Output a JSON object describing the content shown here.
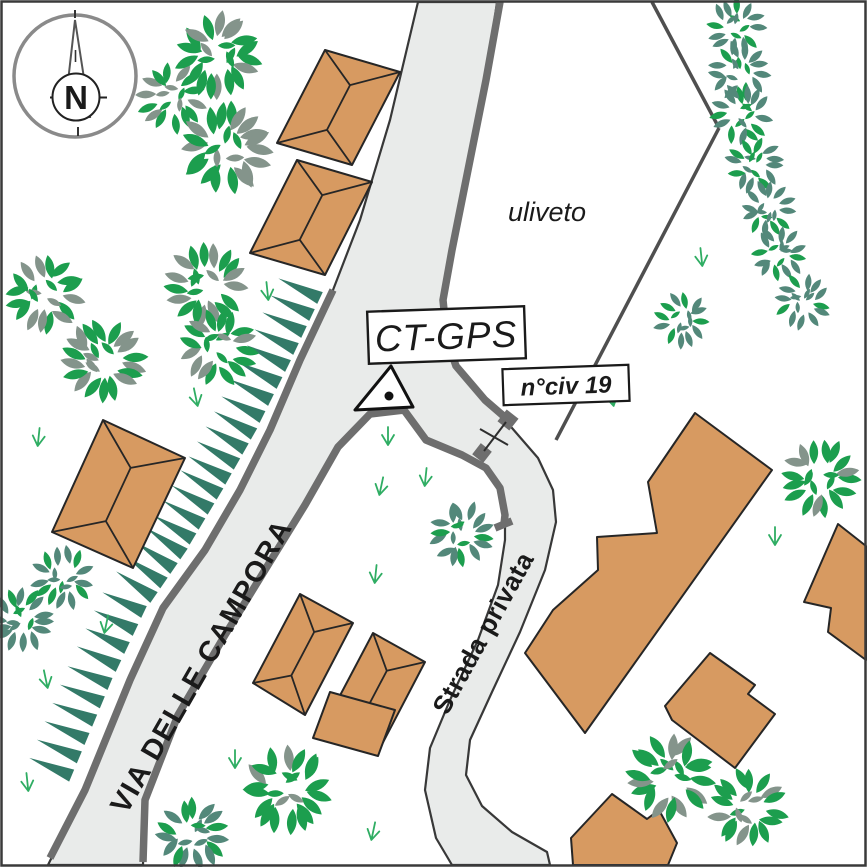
{
  "labels": {
    "compass_north": "N",
    "street_main": "VIA DELLE CAMPORA",
    "street_private": "Strada privata",
    "station": "CT-GPS",
    "civic_number": "n°civ 19",
    "olive_grove": "uliveto"
  },
  "colors": {
    "background": "#FFFFFF",
    "road_fill": "#E9EBEA",
    "road_edge": "#383838",
    "wall_gray": "#6E6E6E",
    "fence_gray": "#4F4F4F",
    "building_fill": "#D79A61",
    "building_edge": "#262626",
    "leaf_green": "#1C9E4E",
    "leaf_gray": "#84948B",
    "leaf_teal": "#53887A",
    "scarp_teal": "#337A68",
    "grass_green": "#2FAD63",
    "compass_gray": "#8A8A8A",
    "ink": "#1A1A1A",
    "frame": "#3A3A3A"
  },
  "map": {
    "road_path": "M418,2 L497,2 L486,80 L468,170 L452,250 L443,300 L447,340 L456,366 L485,400 L512,428 L538,458 L553,490 L556,522 L545,570 L520,632 L492,692 L470,740 L466,775 L482,806 L512,832 L547,852 L550,865 L452,865 L436,838 L425,790 L430,748 L450,700 L478,640 L498,585 L505,540 L505,515 L500,488 L486,468 L462,455 L426,440 L404,410 L370,414 L338,447 L305,505 L268,565 L225,635 L178,715 L145,800 L143,865 L48,865 L85,790 L130,680 L163,608 L205,550 L240,490 L270,430 L300,360 L333,290 L360,220 L390,120 Z",
    "walls": [
      [
        [
          500,
          2
        ],
        [
          486,
          80
        ],
        [
          468,
          170
        ],
        [
          452,
          250
        ],
        [
          443,
          300
        ],
        [
          447,
          340
        ],
        [
          456,
          366
        ],
        [
          485,
          400
        ],
        [
          507,
          419
        ]
      ],
      [
        [
          143,
          862
        ],
        [
          145,
          800
        ],
        [
          178,
          715
        ],
        [
          225,
          635
        ],
        [
          268,
          565
        ],
        [
          305,
          505
        ],
        [
          338,
          447
        ],
        [
          370,
          414
        ],
        [
          404,
          410
        ],
        [
          426,
          440
        ],
        [
          462,
          455
        ],
        [
          486,
          468
        ],
        [
          500,
          488
        ],
        [
          505,
          515
        ],
        [
          504,
          524
        ]
      ],
      [
        [
          333,
          290
        ],
        [
          300,
          360
        ],
        [
          270,
          430
        ],
        [
          240,
          490
        ],
        [
          205,
          550
        ],
        [
          163,
          608
        ],
        [
          130,
          680
        ],
        [
          85,
          790
        ],
        [
          50,
          858
        ]
      ],
      [
        [
          495,
          528
        ],
        [
          512,
          521
        ]
      ]
    ],
    "posts": [
      {
        "x": 508,
        "y": 420,
        "s": 15,
        "rot": 38
      },
      {
        "x": 482,
        "y": 453,
        "s": 14,
        "rot": 38
      }
    ],
    "gate_lines": [
      [
        [
          506,
          422
        ],
        [
          484,
          451
        ]
      ],
      [
        [
          480,
          429
        ],
        [
          508,
          445
        ]
      ]
    ],
    "fences": [
      [
        [
          652,
          2
        ],
        [
          719,
          128
        ]
      ],
      [
        [
          719,
          128
        ],
        [
          556,
          440
        ]
      ]
    ],
    "scarp": {
      "base": [
        [
          320,
          298
        ],
        [
          288,
          366
        ],
        [
          254,
          434
        ],
        [
          220,
          494
        ],
        [
          184,
          554
        ],
        [
          144,
          612
        ],
        [
          110,
          684
        ],
        [
          64,
          794
        ]
      ],
      "spacing": 19,
      "length": 46,
      "halfwidth": 6.5
    },
    "buildings": [
      {
        "pts": [
          [
            325,
            50
          ],
          [
            400,
            72
          ],
          [
            352,
            165
          ],
          [
            277,
            143
          ]
        ],
        "roof": "hip"
      },
      {
        "pts": [
          [
            297,
            160
          ],
          [
            372,
            182
          ],
          [
            325,
            275
          ],
          [
            250,
            253
          ]
        ],
        "roof": "hip"
      },
      {
        "pts": [
          [
            103,
            420
          ],
          [
            185,
            458
          ],
          [
            133,
            568
          ],
          [
            52,
            532
          ]
        ],
        "roof": "hip"
      },
      {
        "pts": [
          [
            300,
            594
          ],
          [
            353,
            623
          ],
          [
            305,
            715
          ],
          [
            253,
            683
          ]
        ],
        "roof": "hip"
      },
      {
        "pts": [
          [
            373,
            633
          ],
          [
            425,
            662
          ],
          [
            378,
            752
          ],
          [
            326,
            722
          ]
        ],
        "roof": "hip"
      },
      {
        "pts": [
          [
            695,
            413
          ],
          [
            772,
            470
          ],
          [
            585,
            733
          ],
          [
            525,
            653
          ],
          [
            553,
            610
          ],
          [
            598,
            570
          ],
          [
            597,
            537
          ],
          [
            657,
            533
          ],
          [
            648,
            482
          ]
        ],
        "roof": "none"
      },
      {
        "pts": [
          [
            838,
            524
          ],
          [
            866,
            546
          ],
          [
            866,
            660
          ],
          [
            828,
            632
          ],
          [
            831,
            608
          ],
          [
            804,
            602
          ]
        ],
        "roof": "none"
      },
      {
        "pts": [
          [
            665,
            706
          ],
          [
            710,
            653
          ],
          [
            755,
            685
          ],
          [
            748,
            694
          ],
          [
            775,
            714
          ],
          [
            735,
            768
          ],
          [
            672,
            720
          ]
        ],
        "roof": "none"
      },
      {
        "pts": [
          [
            612,
            794
          ],
          [
            647,
            819
          ],
          [
            659,
            810
          ],
          [
            677,
            843
          ],
          [
            668,
            865
          ],
          [
            573,
            865
          ],
          [
            571,
            838
          ]
        ],
        "roof": "none"
      },
      {
        "pts": [
          [
            330,
            692
          ],
          [
            395,
            710
          ],
          [
            378,
            756
          ],
          [
            313,
            738
          ]
        ],
        "roof": "none"
      }
    ],
    "trees": [
      {
        "x": 218,
        "y": 55,
        "r": 40,
        "style": "bright"
      },
      {
        "x": 172,
        "y": 98,
        "r": 32,
        "style": "bright"
      },
      {
        "x": 226,
        "y": 148,
        "r": 42,
        "style": "bright"
      },
      {
        "x": 45,
        "y": 295,
        "r": 36,
        "style": "bright"
      },
      {
        "x": 103,
        "y": 360,
        "r": 39,
        "style": "bright"
      },
      {
        "x": 205,
        "y": 285,
        "r": 38,
        "style": "bright"
      },
      {
        "x": 218,
        "y": 347,
        "r": 36,
        "style": "bright"
      },
      {
        "x": 287,
        "y": 789,
        "r": 40,
        "style": "bright"
      },
      {
        "x": 820,
        "y": 478,
        "r": 36,
        "style": "bright"
      },
      {
        "x": 670,
        "y": 777,
        "r": 40,
        "style": "bright"
      },
      {
        "x": 748,
        "y": 808,
        "r": 36,
        "style": "bright"
      },
      {
        "x": 736,
        "y": 27,
        "r": 27,
        "style": "olive"
      },
      {
        "x": 739,
        "y": 72,
        "r": 28,
        "style": "olive"
      },
      {
        "x": 741,
        "y": 114,
        "r": 28,
        "style": "olive"
      },
      {
        "x": 755,
        "y": 165,
        "r": 27,
        "style": "olive"
      },
      {
        "x": 769,
        "y": 209,
        "r": 26,
        "style": "olive"
      },
      {
        "x": 779,
        "y": 254,
        "r": 26,
        "style": "olive"
      },
      {
        "x": 803,
        "y": 301,
        "r": 26,
        "style": "olive"
      },
      {
        "x": 682,
        "y": 320,
        "r": 26,
        "style": "olive"
      },
      {
        "x": 462,
        "y": 534,
        "r": 30,
        "style": "olive"
      },
      {
        "x": 63,
        "y": 578,
        "r": 29,
        "style": "olive"
      },
      {
        "x": 22,
        "y": 620,
        "r": 30,
        "style": "olive"
      },
      {
        "x": 193,
        "y": 835,
        "r": 34,
        "style": "olive"
      }
    ],
    "grass": [
      [
        197,
        403
      ],
      [
        268,
        297
      ],
      [
        388,
        442
      ],
      [
        425,
        483
      ],
      [
        380,
        492
      ],
      [
        613,
        403
      ],
      [
        702,
        263
      ],
      [
        775,
        542
      ],
      [
        38,
        443
      ],
      [
        105,
        630
      ],
      [
        47,
        685
      ],
      [
        28,
        788
      ],
      [
        235,
        765
      ],
      [
        375,
        580
      ],
      [
        372,
        837
      ]
    ],
    "station": {
      "triangle": [
        [
          391,
          366
        ],
        [
          355,
          410
        ],
        [
          413,
          407
        ]
      ],
      "dot": [
        389,
        396
      ]
    }
  }
}
